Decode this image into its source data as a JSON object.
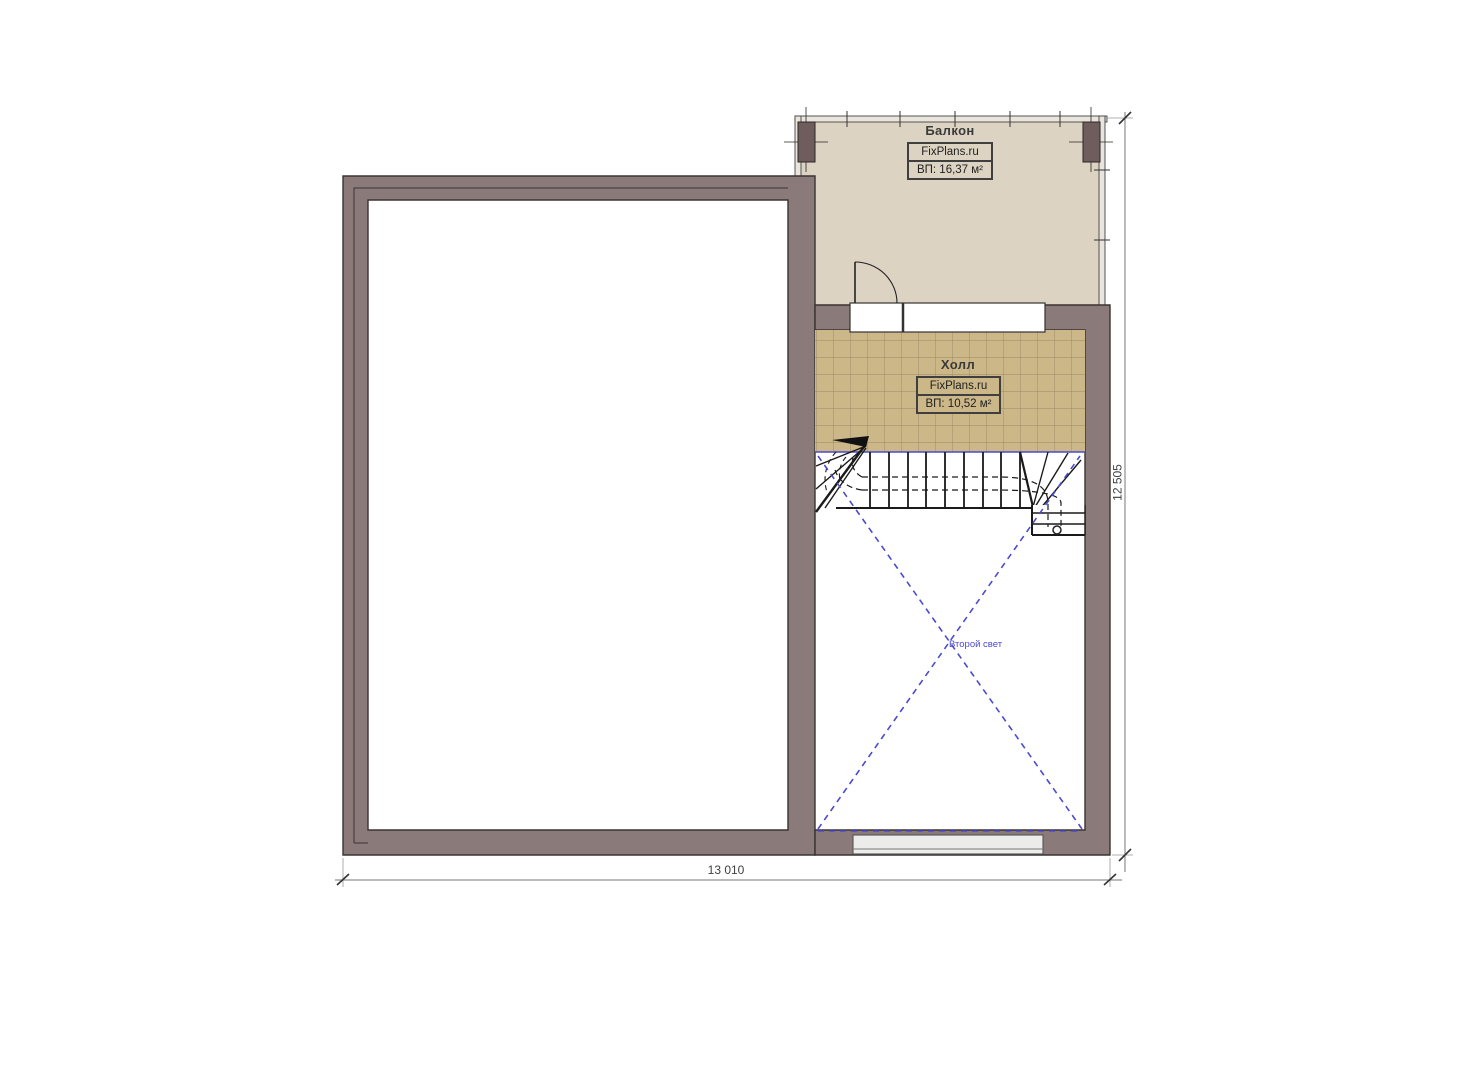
{
  "plan": {
    "type": "floor-plan",
    "rooms": {
      "balcony": {
        "label": "Балкон",
        "brand": "FixPlans.ru",
        "area": "ВП: 16,37 м²"
      },
      "hall": {
        "label": "Холл",
        "brand": "FixPlans.ru",
        "area": "ВП: 10,52 м²"
      },
      "void": {
        "label": "Второй свет"
      }
    },
    "dimensions": {
      "width": "13 010",
      "height": "12 505"
    },
    "colors": {
      "wall": "#8b7a7a",
      "wall_outline": "#3b3333",
      "column": "#6f5d5d",
      "balcony_floor": "#ddd3c2",
      "railing": "#e9e5dd",
      "tile": "#ccb789",
      "tile_grout": "#9a8a63",
      "accent_blue": "#4c4ace",
      "stair_line": "#1a1a1a",
      "window_fill": "#ececea",
      "dimension_line": "#777777"
    }
  }
}
